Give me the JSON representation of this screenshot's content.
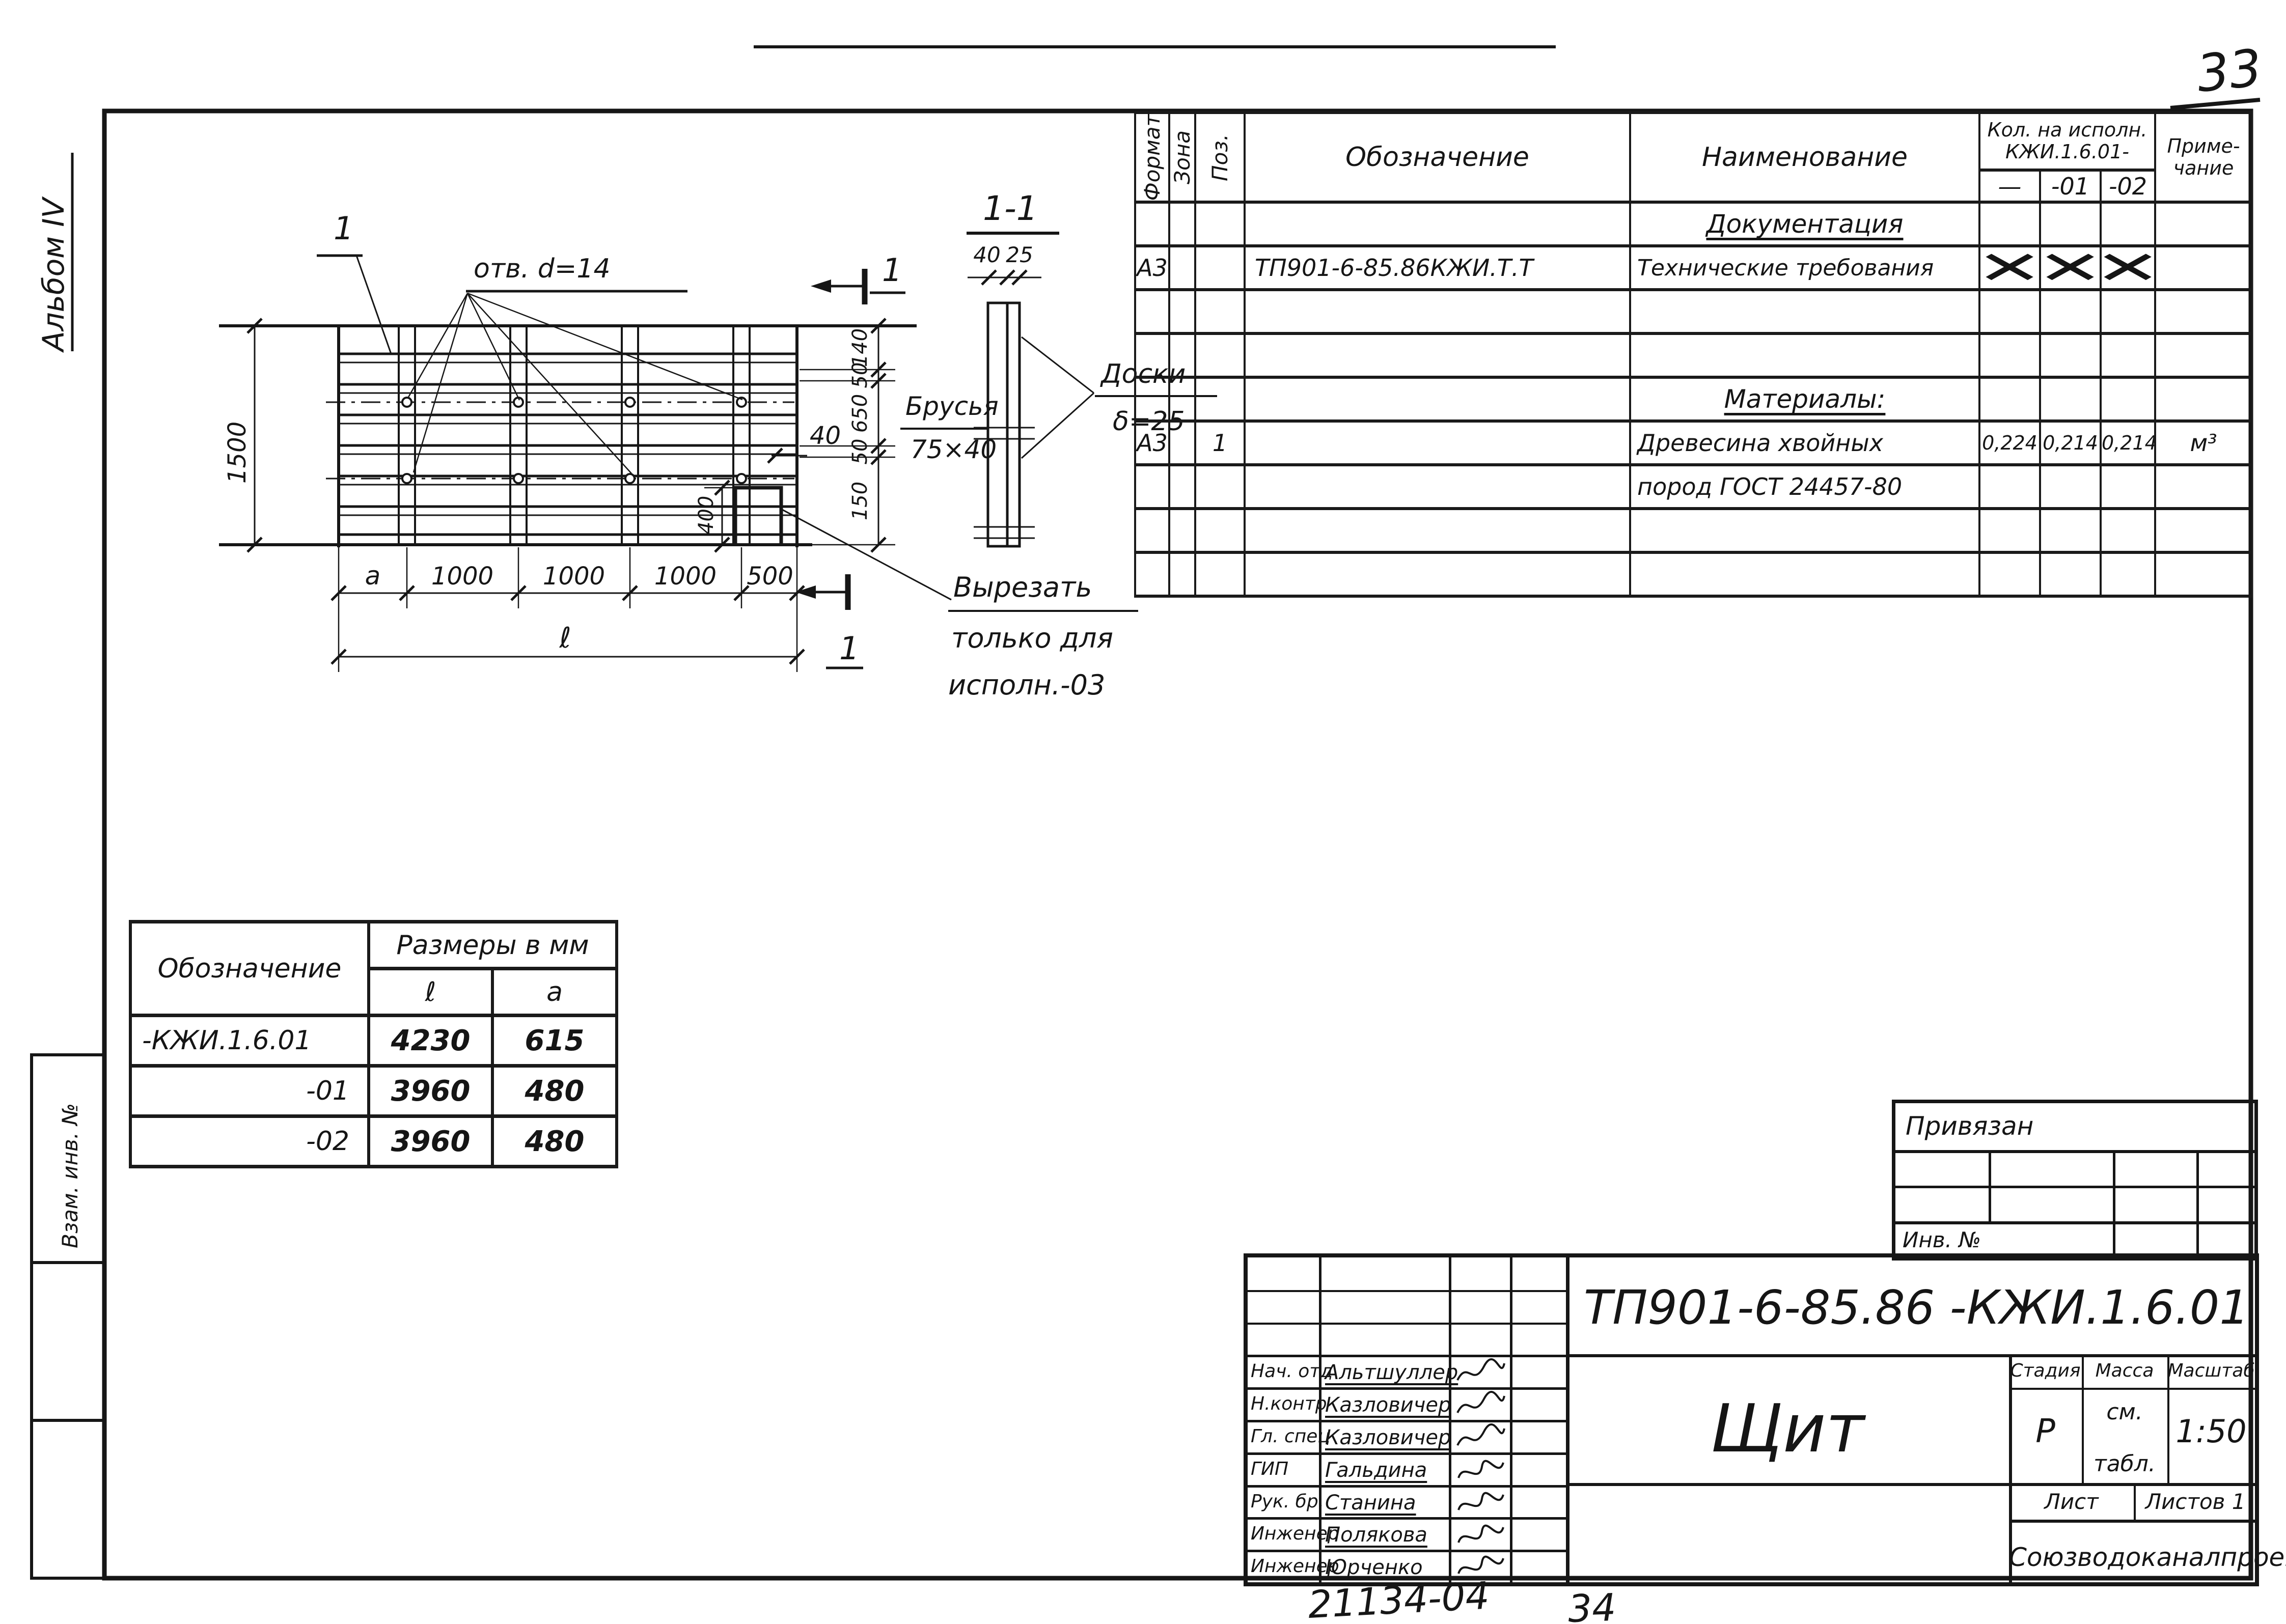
{
  "page": {
    "sheet_number_handwritten": "33",
    "album_label": "Альбом IV",
    "margin_stamp": "Взам. инв. №",
    "footer_number": "21134-04",
    "footer_page": "34"
  },
  "spec_table": {
    "col_format": "Формат",
    "col_zone": "Зона",
    "col_pos": "Поз.",
    "col_designation": "Обозначение",
    "col_name": "Наименование",
    "qty_header_line1": "Кол. на исполн.",
    "qty_header_line2": "КЖИ.1.6.01-",
    "qty_cols": [
      "—",
      "-01",
      "-02"
    ],
    "col_note_line1": "Приме-",
    "col_note_line2": "чание",
    "section_documentation": "Документация",
    "doc_row": {
      "format": "А3",
      "designation": "ТП901-6-85.86КЖИ.Т.Т",
      "name": "Технические требования",
      "marks": [
        "✕",
        "✕",
        "✕"
      ]
    },
    "section_materials": "Материалы:",
    "material_row": {
      "format": "А3",
      "pos": "1",
      "name_line1": "Древесина хвойных",
      "name_line2": "пород ГОСТ 24457-80",
      "qty": [
        "0,224",
        "0,214",
        "0,214"
      ],
      "unit": "м³"
    }
  },
  "drawing": {
    "pos_label": "1",
    "holes_label": "отв. d=14",
    "dim_height": "1500",
    "dim_40": "40",
    "dim_400": "400",
    "right_chain": [
      "140",
      "50",
      "650",
      "50",
      "150"
    ],
    "bottom_dims": [
      "a",
      "1000",
      "1000",
      "1000",
      "500"
    ],
    "dim_total": "ℓ",
    "section_mark_top": "1",
    "section_mark_bottom": "1",
    "section_title": "1-1",
    "section_dim_40": "40",
    "section_dim_25": "25",
    "boards_label_line1": "Доски",
    "boards_label_line2": "δ=25",
    "battens_label_line1": "Брусья",
    "battens_label_line2": "75×40",
    "cut_note_line1": "Вырезать",
    "cut_note_line2": "только для",
    "cut_note_line3": "исполн.-03"
  },
  "dim_table": {
    "col_designation": "Обозначение",
    "col_sizes": "Размеры в мм",
    "col_l": "ℓ",
    "col_a": "a",
    "rows": [
      {
        "designation": "-КЖИ.1.6.01",
        "l": "4230",
        "a": "615"
      },
      {
        "designation": "-01",
        "l": "3960",
        "a": "480"
      },
      {
        "designation": "-02",
        "l": "3960",
        "a": "480"
      }
    ]
  },
  "binding_block": {
    "title": "Привязан",
    "inv_label": "Инв. №"
  },
  "title_block": {
    "doc_number": "ТП901-6-85.86  -КЖИ.1.6.01",
    "title": "Щит",
    "stage_label": "Стадия",
    "mass_label": "Масса",
    "scale_label": "Масштаб",
    "stage": "Р",
    "mass_line1": "см.",
    "mass_line2": "табл.",
    "scale": "1:50",
    "sheet_label": "Лист",
    "sheets_label": "Листов 1",
    "organization": "Союзводоканалпроект",
    "signatures": [
      {
        "role": "Нач. отд",
        "name": "Альтшуллер"
      },
      {
        "role": "Н.контр",
        "name": "Казловичер"
      },
      {
        "role": "Гл. спец",
        "name": "Казловичер"
      },
      {
        "role": "ГИП",
        "name": "Гальдина"
      },
      {
        "role": "Рук. бр.",
        "name": "Станина"
      },
      {
        "role": "Инженер",
        "name": "Полякова"
      },
      {
        "role": "Инженер",
        "name": "Юрченко"
      }
    ]
  }
}
